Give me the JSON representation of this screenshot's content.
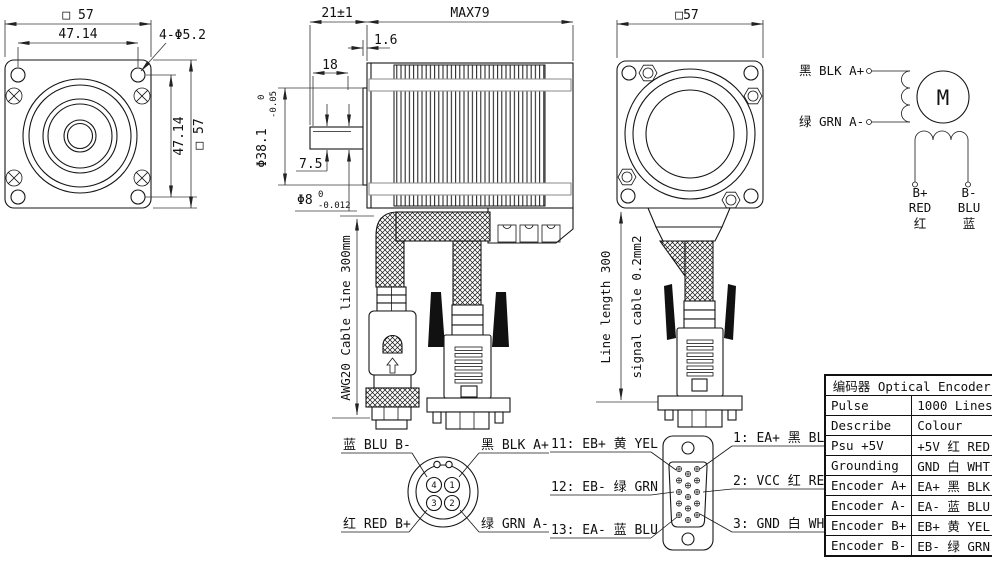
{
  "front_view": {
    "dim_top_square": "□ 57",
    "dim_top_holes": "47.14",
    "holes_label": "4-Φ5.2",
    "dim_right_holes": "47.14",
    "dim_right_square": "□ 57"
  },
  "side_view": {
    "dim_shaft_len": "21±1",
    "dim_body_len": "MAX79",
    "dim_boss_height": "1.6",
    "dim_flat_len": "18",
    "dim_pilot_dia": "Φ38.1",
    "dim_pilot_tol_top": "0",
    "dim_pilot_tol_bottom": "-0.05",
    "dim_flat_depth": "7.5",
    "dim_shaft_dia": "Φ8",
    "dim_shaft_tol_top": "0",
    "dim_shaft_tol_bottom": "-0.012",
    "cable_label": "AWG20 Cable line 300mm"
  },
  "rear_view": {
    "dim_top_square": "□57",
    "line_length_label": "Line length 300",
    "signal_cable_label": "signal cable 0.2mm2"
  },
  "schematic": {
    "motor": "M",
    "phase_a_plus": "黑 BLK A+",
    "phase_a_minus": "绿 GRN A-",
    "b_plus_1": "B+",
    "b_plus_2": "RED",
    "b_plus_3": "红",
    "b_minus_1": "B-",
    "b_minus_2": "BLU",
    "b_minus_3": "蓝"
  },
  "round_connector": {
    "label_top_left": "蓝 BLU B-",
    "label_top_right": "黑 BLK A+",
    "label_bottom_left": "红 RED B+",
    "label_bottom_right": "绿 GRN A-",
    "pin1": "1",
    "pin2": "2",
    "pin3": "3",
    "pin4": "4"
  },
  "db_connector": {
    "left_labels": [
      "11: EB+ 黄 YEL",
      "12: EB- 绿 GRN",
      "13: EA- 蓝 BLU"
    ],
    "right_labels": [
      "1: EA+ 黑 BLK",
      "2: VCC 红 RED",
      "3: GND 白 WHT"
    ]
  },
  "encoder_table": {
    "title": "编码器 Optical Encoder",
    "rows": [
      {
        "label": "Pulse",
        "value": "1000 Lines"
      },
      {
        "label": "Describe",
        "value": "Colour"
      },
      {
        "label": "Psu +5V",
        "value": "+5V 红 RED"
      },
      {
        "label": "Grounding",
        "value": "GND 白 WHT"
      },
      {
        "label": "Encoder A+",
        "value": "EA+ 黑 BLK"
      },
      {
        "label": "Encoder A-",
        "value": "EA- 蓝 BLU"
      },
      {
        "label": "Encoder B+",
        "value": "EB+ 黄 YEL"
      },
      {
        "label": "Encoder B-",
        "value": "EB- 绿 GRN"
      }
    ]
  },
  "colors": {
    "line": "#161616",
    "dim": "#3a3a3a",
    "background": "#ffffff"
  }
}
